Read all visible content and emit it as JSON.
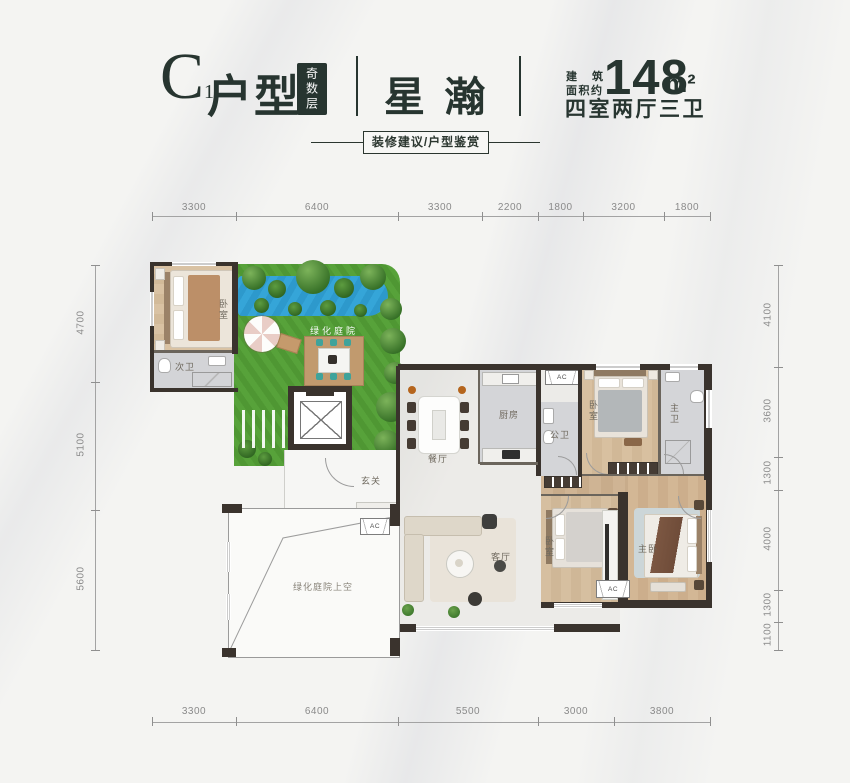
{
  "header": {
    "unit_letter": "C",
    "unit_number": "1",
    "unit_type": "户型",
    "floor_badge": "奇数层",
    "project_name": "星 瀚",
    "area_label_line1": "建  筑",
    "area_label_line2": "面积约",
    "area_value": "148",
    "area_unit": "m²",
    "layout_text": "四室两厅三卫",
    "cta_label": "装修建议/户型鉴赏"
  },
  "dimensions": {
    "top": [
      "3300",
      "6400",
      "3300",
      "2200",
      "1800",
      "3200",
      "1800"
    ],
    "bottom": [
      "3300",
      "6400",
      "5500",
      "3000",
      "3800"
    ],
    "left": [
      "4700",
      "5100",
      "5600"
    ],
    "right": [
      "4100",
      "3600",
      "1300",
      "4000",
      "1300",
      "1100"
    ]
  },
  "rooms": {
    "bedroom_nw": "卧室",
    "bath_secondary": "次卫",
    "garden": "绿化庭院",
    "foyer": "玄关",
    "dining": "餐厅",
    "kitchen": "厨房",
    "bath_public": "公卫",
    "bedroom_ne": "卧室",
    "bath_master": "主卫",
    "living": "客厅",
    "bedroom_south": "卧室",
    "bedroom_master": "主卧",
    "courtyard_void": "绿化庭院上空",
    "ac": "AC"
  },
  "colors": {
    "accent": "#273530",
    "wall": "#3a332d",
    "lawn": "#57a23a",
    "pool": "#35a5d8",
    "wood": "#d8c0a0",
    "tile": "#d3d4d7"
  }
}
